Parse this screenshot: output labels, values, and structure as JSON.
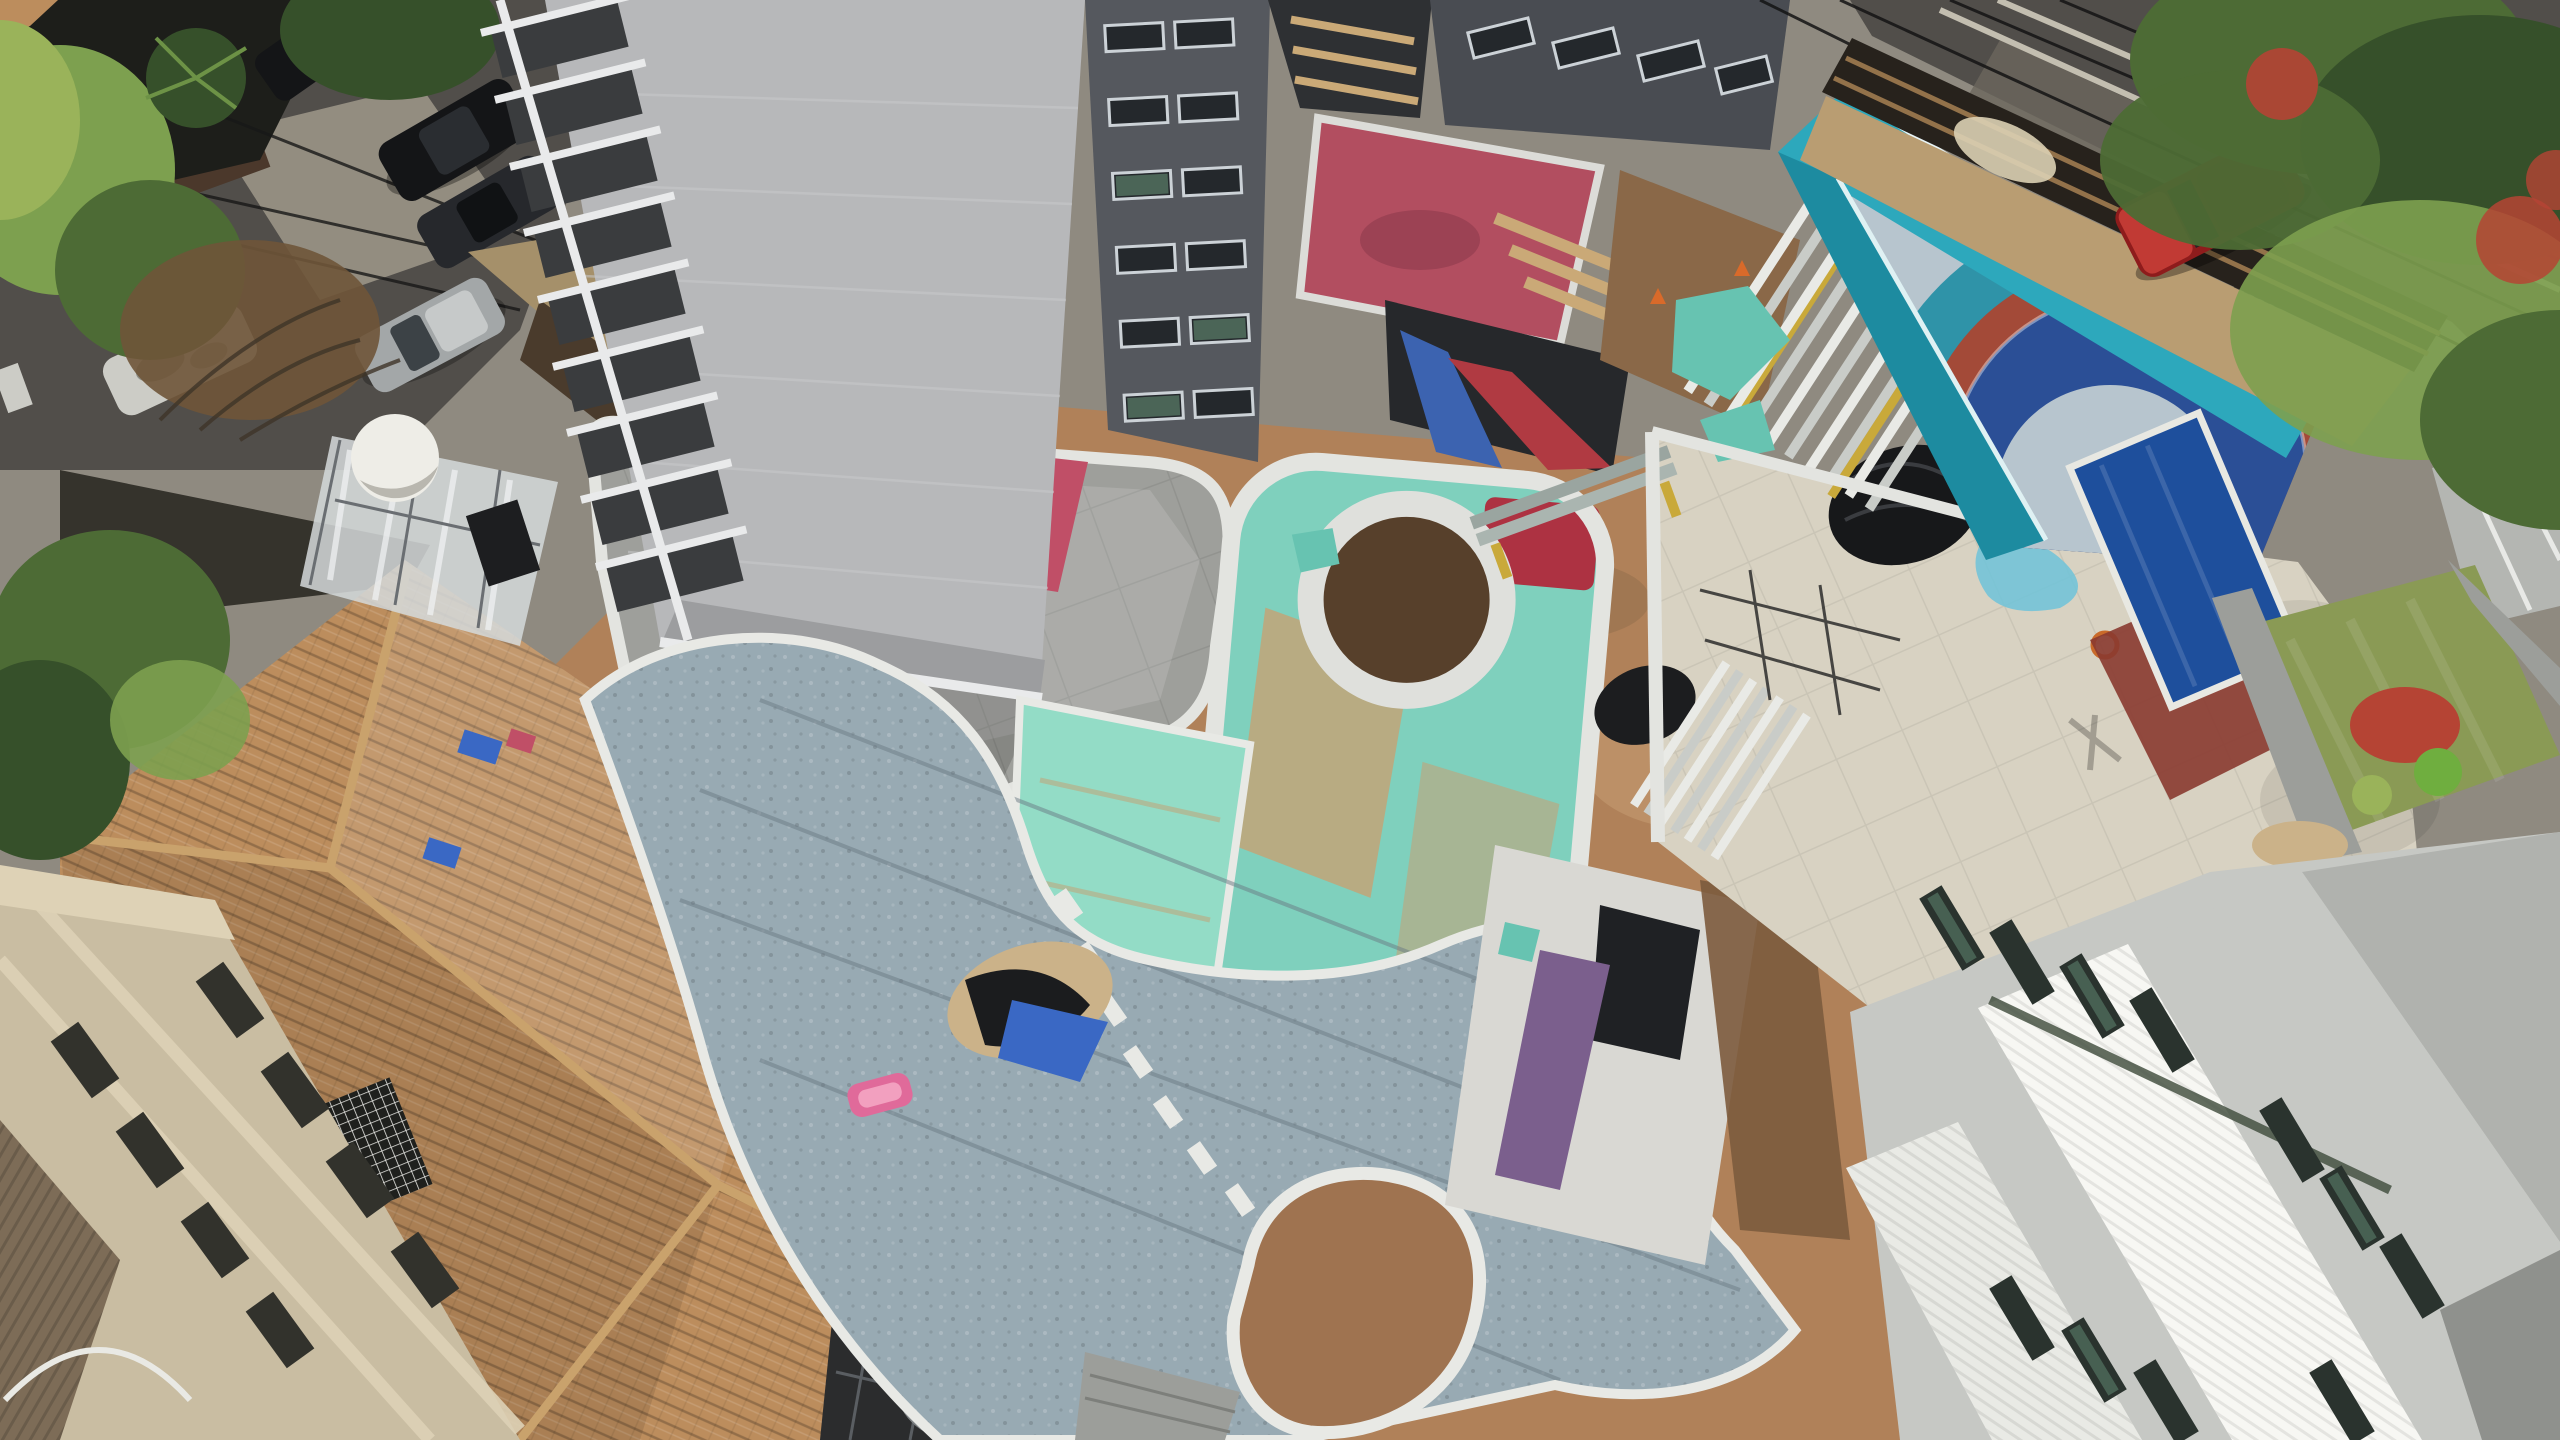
{
  "scene": {
    "labels": {
      "scene": "Aerial drone view of a residential high-rise construction site",
      "left_street": "Tree-lined street with parked cars",
      "tower": "High-rise tower under construction",
      "house": "Neighboring house with terracotta hip roof",
      "beige_building": "Neighboring beige apartment building",
      "deck": "Concrete podium roof deck with tarps",
      "water_tank": "White water tank and plastic-wrapped scaffold",
      "earth": "Compacted earth landscaping area",
      "garden": "Shaded planting bed",
      "enclosure": "Rounded kids-pool enclosure with teal waterproofing and circular planter",
      "teal_slabs": "Teal waterproofed slab area",
      "pool": "Curved leisure pool with gravel bed and island",
      "courtyards": "Service courtyards with pink floor, red ramp and formwork",
      "right_courtyard": "Sunken courtyard with purple strip",
      "terrace": "Beige tiled terrace with stacked scaffold planks",
      "play_court": "Painted play court with concentric circle design",
      "cyan_wall": "Cyan painted court walls",
      "right_street": "Street with timber construction hoarding and red SUV",
      "right_garden": "Neighboring garden with lawn and blue pool",
      "white_building": "White apartment building with ribbed roof",
      "pergola": "Metal pergola with satellite dish"
    },
    "palette": {
      "base": "#8f8a80",
      "asphalt": "#514e4a",
      "asphalt_light": "#6b665d",
      "sidewalk": "#938d80",
      "shadow_dark": "#1d1e1a",
      "tree_dark": "#36502a",
      "tree_mid": "#4d6b35",
      "tree_light": "#7da04f",
      "tree_pale": "#9ab35a",
      "brush_dry": "#6f5539",
      "garage_brown": "#4b382b",
      "stone_wall": "#a5906a",
      "timber_dark": "#4a3b2c",
      "timber_light": "#8a6f4e",
      "alley": "#35332c",
      "earth": "#b08159",
      "earth_light": "#c7a076",
      "dirt_court": "#8a6848",
      "roof_tile": "#bc8d5d",
      "roof_ridge": "#c9a26c",
      "corrugated": "#7d6c57",
      "beige_wall": "#c9bda2",
      "beige_cornice": "#ded2b6",
      "window_slot": "#32322c",
      "garden_dark": "#26261f",
      "planter": "#7c5b3d",
      "deck": "#9e9f9b",
      "deck_light": "#b0b1ab",
      "parapet": "#e3e4e0",
      "tower_core": "#b7b8ba",
      "tower_core_dark": "#9c9d9f",
      "slab": "#e9eaeb",
      "balcony": "#3a3c3e",
      "facade_dark": "#55585e",
      "facade_dark2": "#494c52",
      "win_glass": "#24282c",
      "win_green": "#52705f",
      "win_frame": "#ccd2d7",
      "pit_dark": "#26282b",
      "courtyard_gap": "#2e3033",
      "pink_floor": "#b24e60",
      "red_strip": "#b03a42",
      "formwork_blue": "#3c63b0",
      "board_tan": "#caa977",
      "tarp_pink": "#c04f67",
      "tarp_teal": "#67c3b1",
      "tarp_blue": "#3a68c4",
      "tarp_black": "#17181a",
      "sack": "#eceae2",
      "lumber_orange": "#c06a38",
      "plastic": "#d5d9db",
      "tank": "#eeede7",
      "sign_dark": "#1d1e20",
      "teal_deck": "#7fd0bd",
      "teal_bright": "#93dcc6",
      "teal_dirt": "#c2a478",
      "ring_soil": "#57402b",
      "red_floor": "#ad3242",
      "pool_bed": "#98aab3",
      "curb": "#e8e9e5",
      "island": "#9f7350",
      "sand": "#cbb289",
      "purple": "#7b5f8d",
      "court_white": "#d9d8d3",
      "terrace": "#d8d2c2",
      "splat": "#6fc3d9",
      "navy": "#2b4f96",
      "circle_gray": "#b7c5ce",
      "teal_ring": "#2f93a8",
      "red_band": "#a34a38",
      "cyan": "#2da8bc",
      "cyan_dark": "#1d8ba0",
      "plank_light": "#e9eae6",
      "plank_mid": "#c9ccc8",
      "yellow": "#c9a93a",
      "pipe": "#3a3d40",
      "fence": "#27221c",
      "wood": "#93724a",
      "dirt_strip": "#b99d72",
      "car_red": "#8e1c1c",
      "car_red_hi": "#c13a34",
      "car_silver": "#a3a7a8",
      "car_black": "#141517",
      "car_dark": "#26282c",
      "car_white": "#ccccc6",
      "cone": "#d96a2a",
      "lawn": "#8a9a55",
      "shrub_red": "#b54434",
      "shrub_green": "#6fae3f",
      "path_gray": "#9c9e9a",
      "small_roof": "#b4b6b2",
      "npool": "#1e4f9c",
      "npool_band": "#8a3a30",
      "wb_base": "#c6c8c4",
      "wb_bright": "#f7f7f3",
      "wb_white": "#e9eae5",
      "wb_gray": "#b0b2ae",
      "wb_dark": "#8f918d",
      "wb_win": "#2a332e",
      "hedge": "#3d4a3a",
      "pink_tub": "#e06a9a",
      "mark_white": "#d8d2c2",
      "pergola": "#2b2c2d",
      "dish": "#b5b8b6"
    }
  }
}
